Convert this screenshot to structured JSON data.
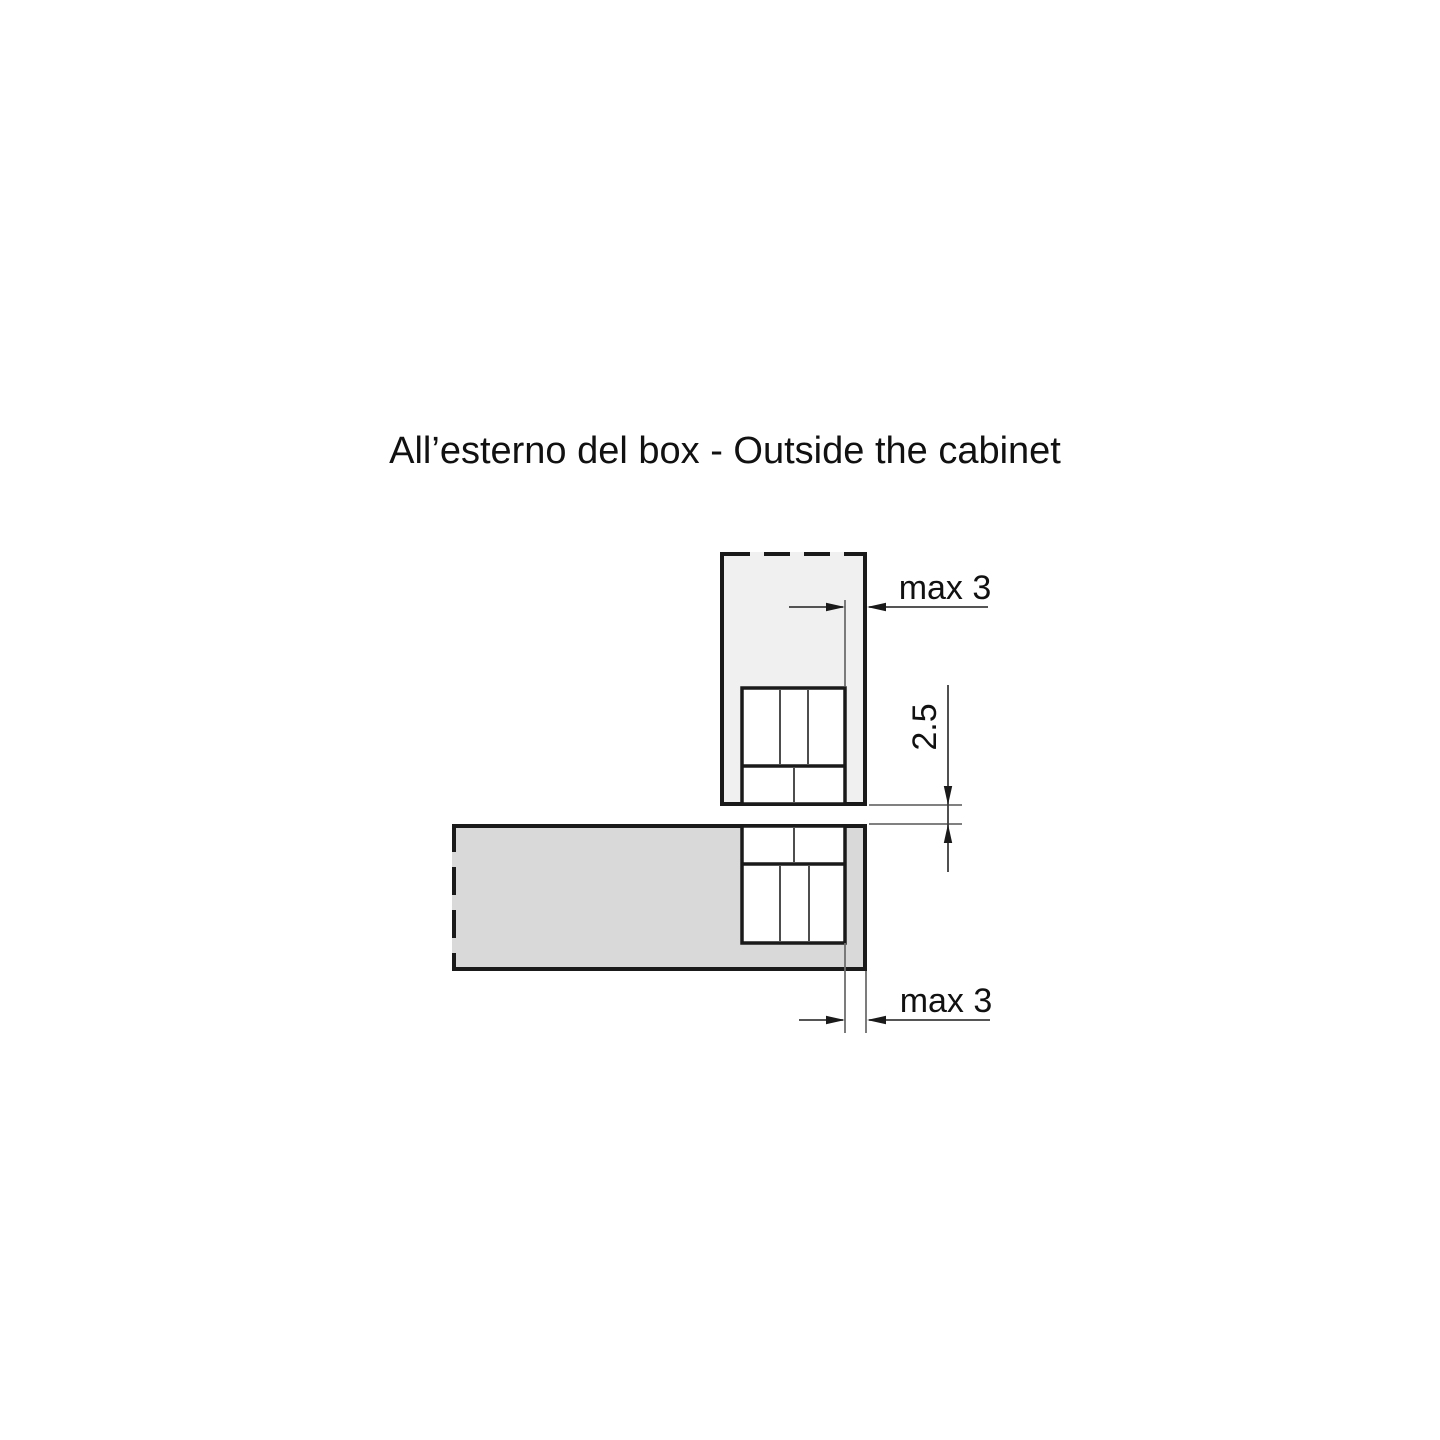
{
  "title": "All’esterno del box - Outside the cabinet",
  "diagram": {
    "labels": {
      "top_gap": "max 3",
      "reveal_gap": "2.5",
      "bottom_gap": "max 3"
    },
    "colors": {
      "door_panel_fill": "#f0f0f0",
      "cabinet_panel_fill": "#d9d9d9",
      "hinge_fill": "#ffffff",
      "outline": "#1a1a1a",
      "dimension_line": "#3d3d3d",
      "extension_line": "#6e6e6e",
      "text": "#111111"
    }
  }
}
